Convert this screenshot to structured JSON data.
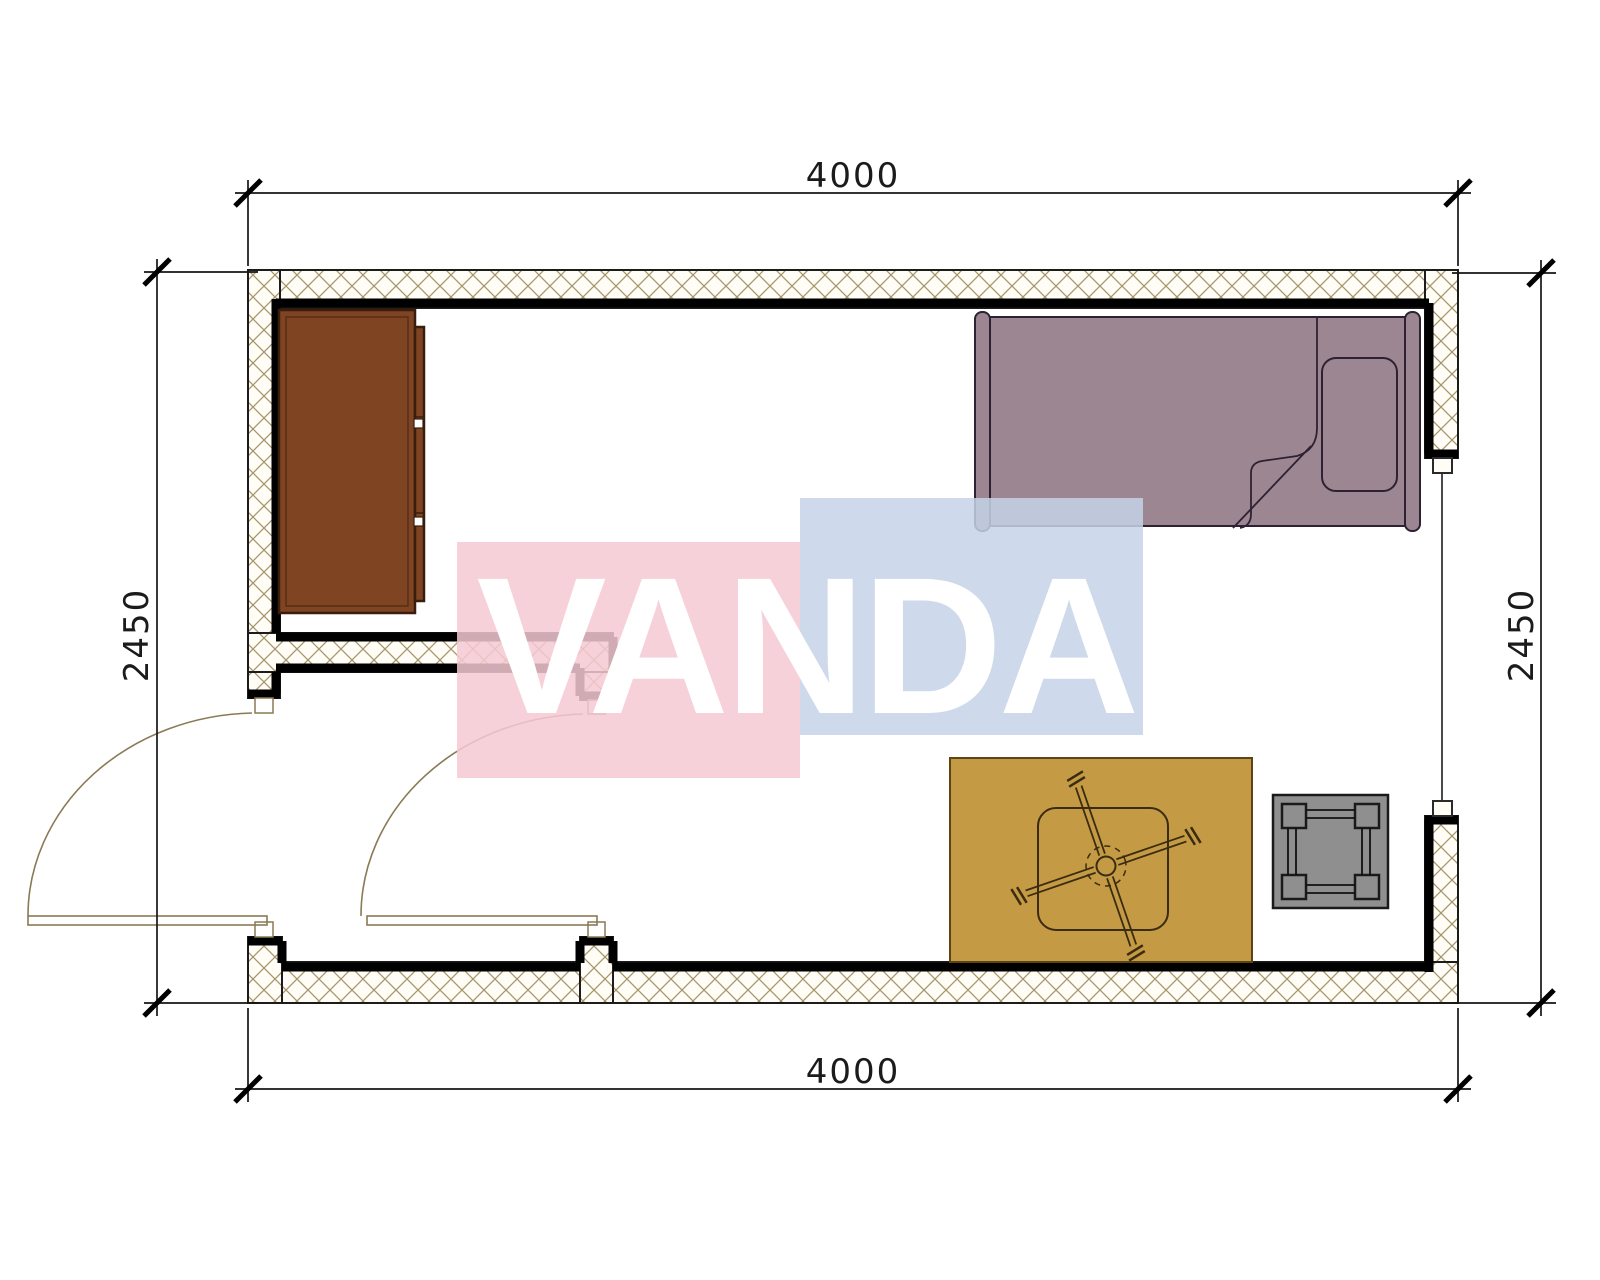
{
  "drawing": {
    "kind": "room floor plan",
    "background": "#ffffff"
  },
  "dimensions": {
    "top": "4000",
    "bottom": "4000",
    "left": "2450",
    "right": "2450"
  },
  "watermark": {
    "text": "VANDA",
    "pink": "#f6c9d4",
    "blue": "#c5d3e7",
    "text_color": "#ffffff"
  },
  "colors": {
    "wall_fill": "#fffdf6",
    "wall_hatch": "#a5966e",
    "wall_line_thick": "#000000",
    "wall_line_thin": "#1c1c1c",
    "door_symbol": "#8a7a55",
    "wardrobe": "#7f4523",
    "bed": "#9c8692",
    "rug": "#c59a44",
    "stool": "#8f8f8f",
    "dimension_text": "#1b1b1b"
  },
  "symbols": {
    "furniture": [
      "wardrobe",
      "single-bed",
      "pillow",
      "rug",
      "table",
      "ceiling-fan",
      "stool"
    ],
    "openings": [
      "entry-door",
      "interior-door",
      "window"
    ]
  }
}
